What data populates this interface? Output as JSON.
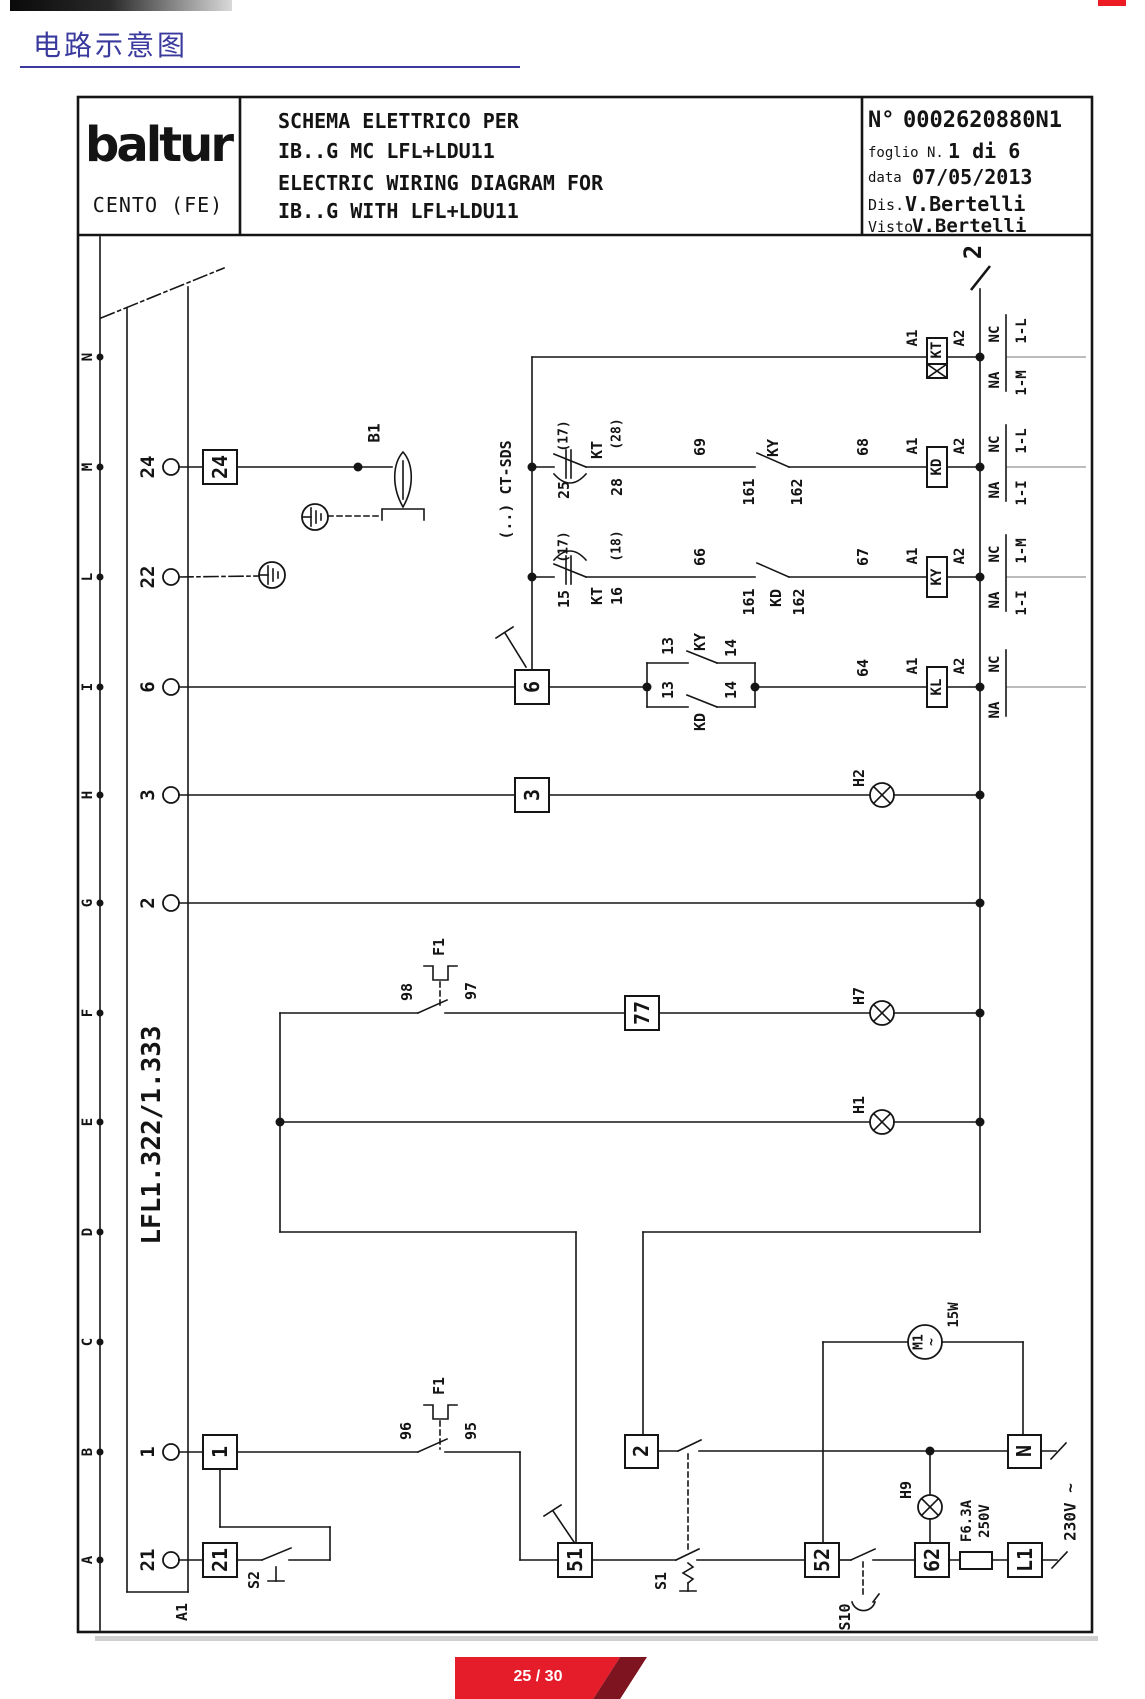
{
  "page": {
    "title_cn": "电路示意图",
    "badge": "25 / 30"
  },
  "title_block": {
    "logo": "baltur",
    "location": "CENTO (FE)",
    "line_it_1": "SCHEMA ELETTRICO PER",
    "line_it_2": "IB..G MC LFL+LDU11",
    "line_en_1": "ELECTRIC WIRING DIAGRAM FOR",
    "line_en_2": "IB..G WITH LFL+LDU11",
    "doc_label": "N°",
    "doc_number": "0002620880N1",
    "sheet_label": "foglio N.",
    "sheet": "1 di 6",
    "date_label": "data",
    "date": "07/05/2013",
    "drawn_label": "Dis.",
    "drawn": "V.Bertelli",
    "approved_label": "Visto",
    "approved": "V.Bertelli"
  },
  "diagram": {
    "rows": [
      "N",
      "M",
      "L",
      "I",
      "H",
      "G",
      "F",
      "E",
      "D",
      "C",
      "B",
      "A"
    ],
    "sheet_ref": "2",
    "module": "LFL1.322/1.333",
    "bus": "(..) CT-SDS",
    "connector": "A1",
    "flame_detector": "B1",
    "terminals": {
      "t24": "24",
      "t22": "22",
      "t6": "6",
      "t3": "3",
      "t2": "2",
      "t1": "1",
      "t21": "21"
    },
    "boxes": {
      "b77": "77",
      "b51": "51",
      "b52": "52",
      "b62": "62",
      "bL1": "L1",
      "bN": "N"
    },
    "relays": {
      "kt": "KT",
      "kd": "KD",
      "ky": "KY",
      "kl": "KL",
      "a1": "A1",
      "a2": "A2"
    },
    "wires": {
      "w13": "13",
      "w14": "14",
      "w15": "15",
      "w16": "16",
      "w25": "25",
      "w28": "28",
      "w64": "64",
      "w66": "66",
      "w67": "67",
      "w68": "68",
      "w69": "69",
      "w95": "95",
      "w96": "96",
      "w97": "97",
      "w98": "98",
      "w161": "161",
      "w162": "162",
      "p17": "(17)",
      "p18": "(18)",
      "p28": "(28)"
    },
    "xref": {
      "na": "NA",
      "nc": "NC",
      "m1": "1-M",
      "l1": "1-L",
      "i1": "1-I"
    },
    "lamps": {
      "h1": "H1",
      "h2": "H2",
      "h7": "H7",
      "h9": "H9"
    },
    "switches": {
      "f1": "F1",
      "s1": "S1",
      "s2": "S2",
      "s10": "S10"
    },
    "motor": {
      "name": "M1",
      "phase": "~",
      "power": "15W"
    },
    "fuse": {
      "rating": "F6.3A",
      "voltage": "250V"
    },
    "supply": "230V ~"
  }
}
